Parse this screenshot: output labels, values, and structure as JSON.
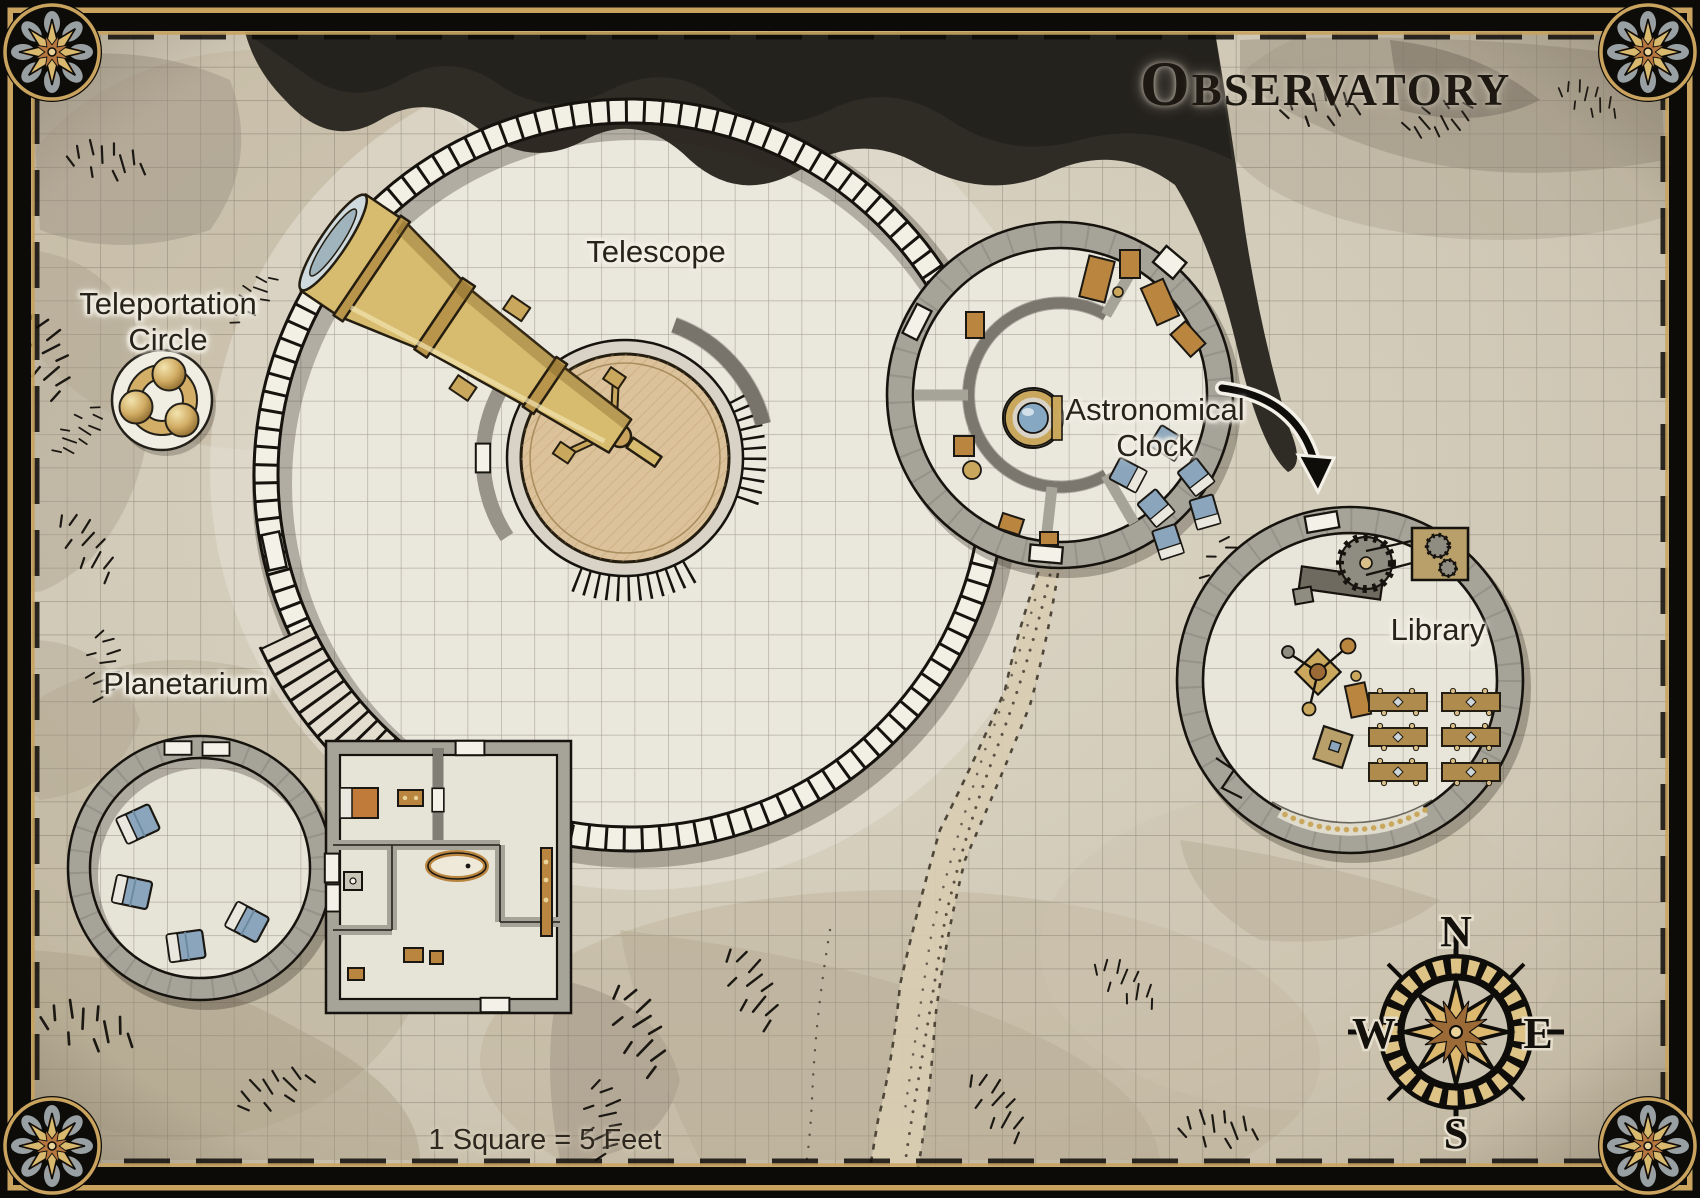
{
  "title": "Observatory",
  "scale_label": "1 Square = 5 Feet",
  "rooms": {
    "telescope": {
      "label": "Telescope"
    },
    "teleportation_circle": {
      "label_line1": "Teleportation",
      "label_line2": "Circle"
    },
    "astronomical_clock": {
      "label_line1": "Astronomical",
      "label_line2": "Clock"
    },
    "library": {
      "label": "Library"
    },
    "planetarium": {
      "label": "Planetarium"
    }
  },
  "compass": {
    "north": "N",
    "east": "E",
    "south": "S",
    "west": "W"
  },
  "colors": {
    "parchment": "#d8d2c2",
    "ink": "#1d1812",
    "stone_wall": "#a6a399",
    "dome_floor": "#eae7dd",
    "brass": "#d7bb6e",
    "wood_platform": "#dcc29a",
    "furniture_wood": "#b9853f",
    "furniture_blue": "#8ba6bc",
    "gold_accent": "#c9a75c",
    "dark_rock": "#2f2c26"
  }
}
